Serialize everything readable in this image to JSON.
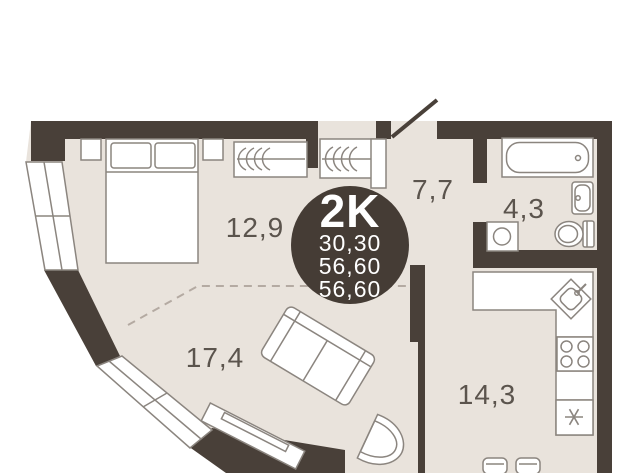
{
  "badge": {
    "type": "2K",
    "lines": [
      "30,30",
      "56,60",
      "56,60"
    ]
  },
  "rooms": {
    "bedroom": "12,9",
    "living": "17,4",
    "hallway": "7,7",
    "bathroom": "4,3",
    "kitchen": "14,3"
  },
  "colors": {
    "wall": "#494039",
    "floor": "#e9e3dc",
    "badge": "#453c35",
    "furniture_line": "#8b857f",
    "label": "#5b544d",
    "dash": "#b4aaa2",
    "white": "#ffffff"
  }
}
